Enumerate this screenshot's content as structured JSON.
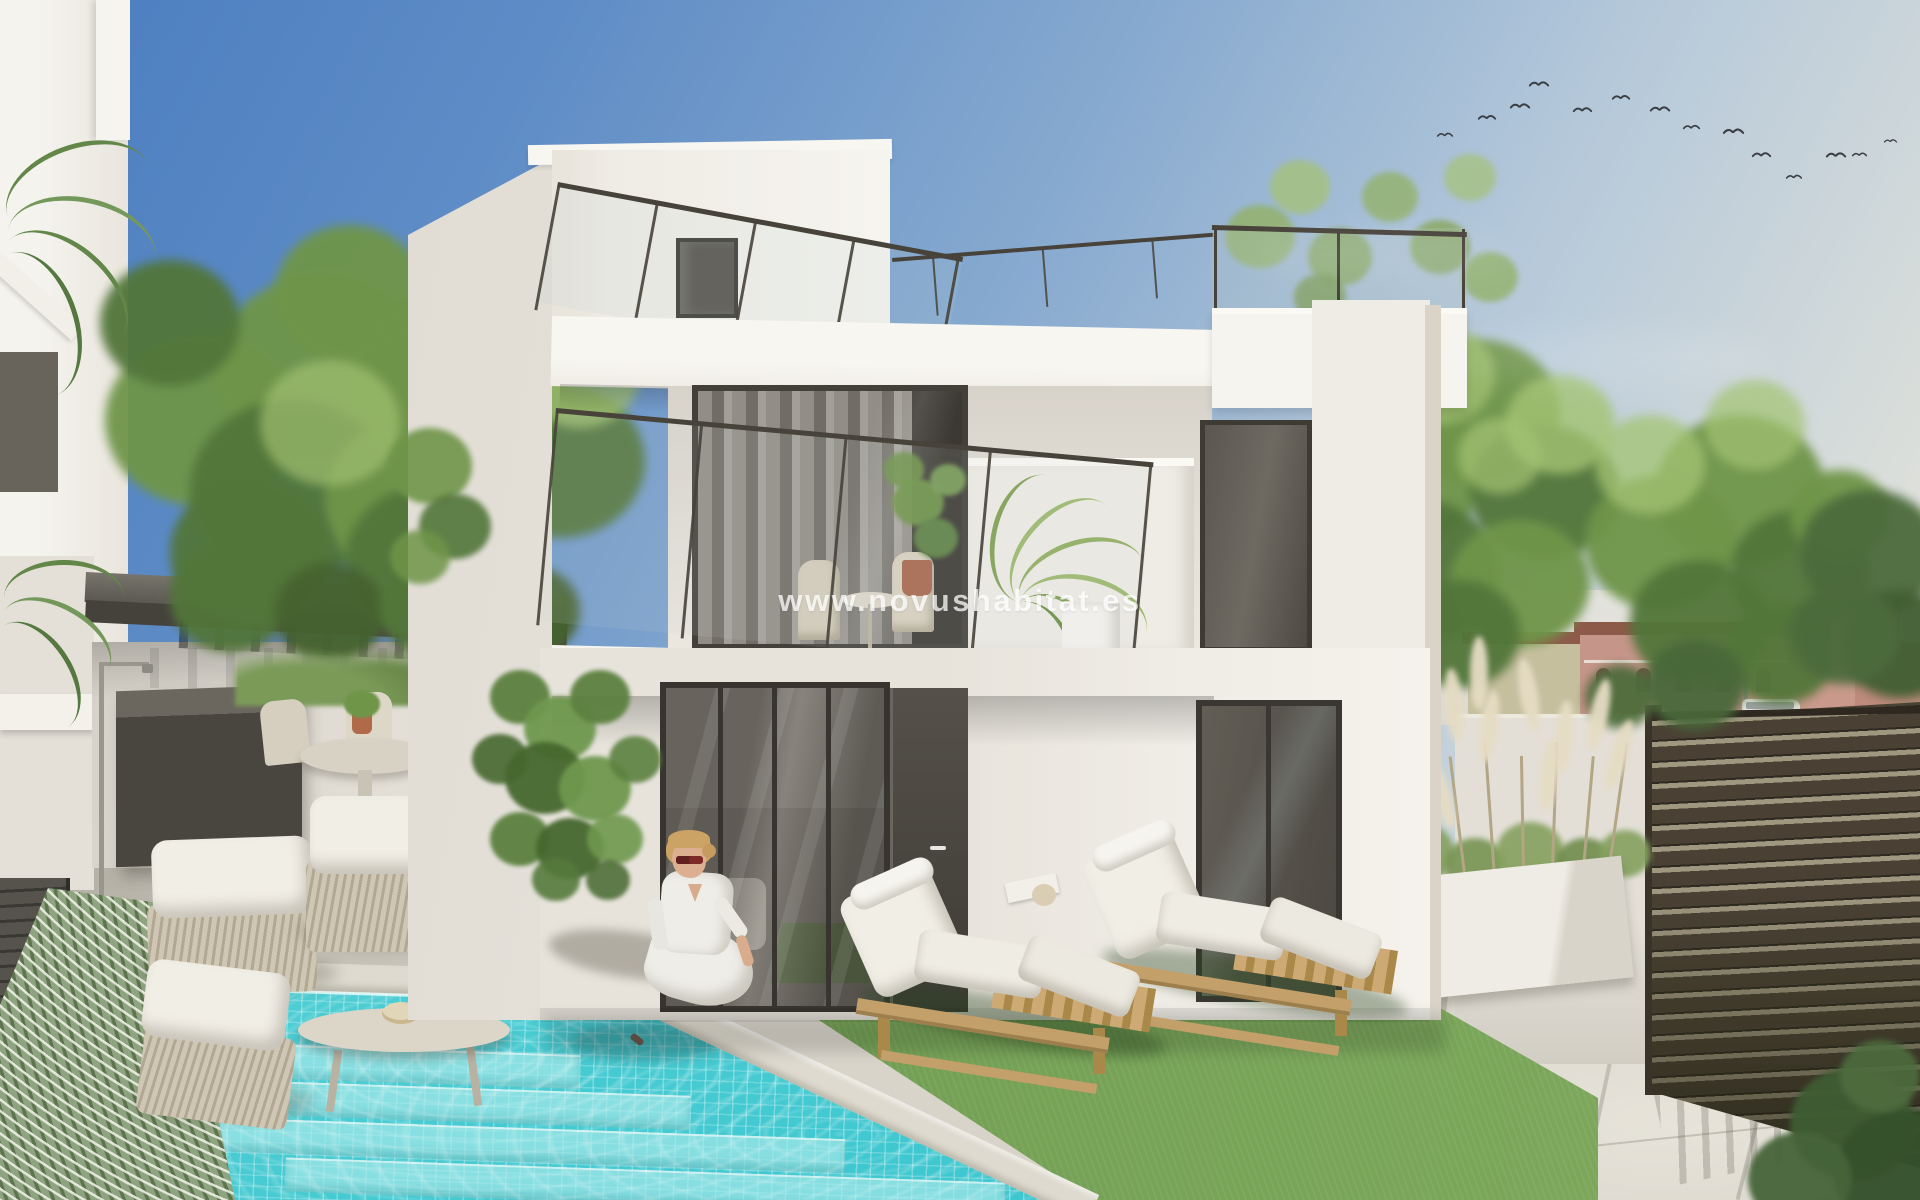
{
  "watermark": {
    "text": "www.novushabitat.es"
  },
  "scene": {
    "type": "architectural-render",
    "elements": [
      "modern-white-villa",
      "swimming-pool",
      "sun-loungers",
      "woman-by-pool",
      "pergola-lounge",
      "slat-fence",
      "garden-wall",
      "pampas-planter",
      "lawn",
      "trees",
      "neighbor-houses",
      "bird-flock"
    ],
    "birds": {
      "count": 14,
      "positions": [
        [
          1437,
          130,
          16
        ],
        [
          1478,
          112,
          18
        ],
        [
          1510,
          100,
          20
        ],
        [
          1529,
          78,
          20
        ],
        [
          1573,
          104,
          19
        ],
        [
          1612,
          92,
          18
        ],
        [
          1650,
          103,
          20
        ],
        [
          1683,
          122,
          17
        ],
        [
          1723,
          125,
          21
        ],
        [
          1752,
          149,
          19
        ],
        [
          1786,
          172,
          16
        ],
        [
          1826,
          149,
          20
        ],
        [
          1852,
          150,
          15
        ],
        [
          1884,
          137,
          13
        ]
      ]
    }
  },
  "palette": {
    "sky_top": "#4a7cbf",
    "sky_mid": "#86a9cf",
    "sky_horizon": "#e9e8e0",
    "wall_bright": "#f6f4ef",
    "wall_light": "#efece5",
    "wall_shade": "#e4e0d8",
    "wall_deep": "#d6d1c6",
    "glass_dark": "#55514a",
    "frame_dark": "#3a3733",
    "curtain": "#8f8b84",
    "metal": "#47423a",
    "pergola_top": "#77746c",
    "pergola_dark": "#45423c",
    "pool_light": "#85e0e2",
    "pool_deep": "#31c2cc",
    "coping": "#dedacf",
    "paving": "#d6d2c8",
    "paving_shadow": "#b9b5ab",
    "lawn": "#74a055",
    "lawn_dark": "#4f7340",
    "hedge": "#8ea37f",
    "fence_dark": "#48402f",
    "fence_gap": "#a09781",
    "tree_light": "#a4c473",
    "tree_mid": "#6f9549",
    "tree_dark": "#52763a",
    "tree_back": "#4c6b3c",
    "distant_wall": "#c6958a",
    "distant_roof": "#8d5a49",
    "wood": "#c39f6a",
    "wood_dark": "#a98849",
    "cushion": "#f1eee6",
    "skin": "#d9ac8d",
    "hair": "#cba365",
    "shirt": "#efede8",
    "sunglasses": "#7c2a27",
    "plume": "#e6dcc4",
    "bird": "#3a3f45",
    "watermark_color": "#ffffff"
  }
}
